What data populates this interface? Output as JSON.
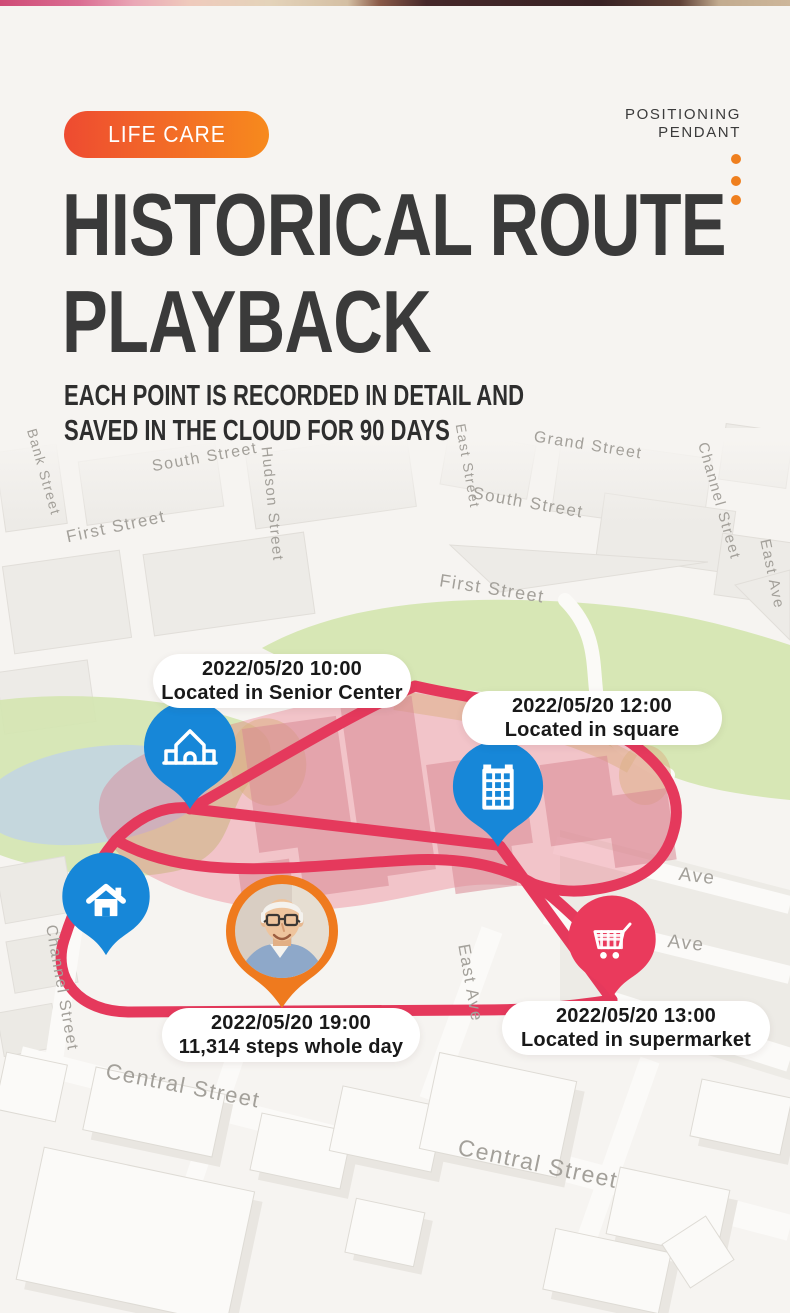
{
  "header": {
    "badge_label": "LIFE CARE",
    "product_line1": "POSITIONING",
    "product_line2": "PENDANT",
    "title_line1": "HISTORICAL ROUTE",
    "title_line2": "PLAYBACK",
    "subtitle_line1": "EACH POINT IS RECORDED IN DETAIL AND",
    "subtitle_line2": "SAVED IN THE CLOUD FOR 90 DAYS",
    "badge_gradient_start": "#ee4b31",
    "badge_gradient_end": "#f78a1d",
    "accent_dot_color": "#ef7f1e",
    "title_color": "#3a3a3a"
  },
  "map": {
    "route_color": "#e5395c",
    "zone_color": "#e9556e",
    "pin_blue": "#1787d8",
    "pin_red": "#ea3a5c",
    "pin_orange": "#ef7a1e",
    "park_color": "#d4e5b0",
    "lake_color": "#c2d4e4",
    "street_labels": [
      {
        "text": "South Street"
      },
      {
        "text": "Bank Street"
      },
      {
        "text": "Hudson Street"
      },
      {
        "text": "East Street"
      },
      {
        "text": "Grand Street"
      },
      {
        "text": "Channel Street"
      },
      {
        "text": "South Street"
      },
      {
        "text": "First Street"
      },
      {
        "text": "First Street"
      },
      {
        "text": "East Ave"
      },
      {
        "text": "Ave"
      },
      {
        "text": "Ave"
      },
      {
        "text": "East Ave"
      },
      {
        "text": "Channel Street"
      },
      {
        "text": "Central Street"
      },
      {
        "text": "Central Street"
      }
    ],
    "callouts": [
      {
        "id": "senior-center",
        "line1": "2022/05/20 10:00",
        "line2": "Located in Senior Center"
      },
      {
        "id": "square",
        "line1": "2022/05/20 12:00",
        "line2": "Located in square"
      },
      {
        "id": "steps",
        "line1": "2022/05/20 19:00",
        "line2": "11,314 steps whole day"
      },
      {
        "id": "supermarket",
        "line1": "2022/05/20 13:00",
        "line2": "Located in supermarket"
      }
    ],
    "pins": [
      {
        "id": "senior-center-pin",
        "icon": "building-outline-icon",
        "color": "#1787d8"
      },
      {
        "id": "square-pin",
        "icon": "office-building-icon",
        "color": "#1787d8"
      },
      {
        "id": "home-pin",
        "icon": "home-icon",
        "color": "#1787d8"
      },
      {
        "id": "supermarket-pin",
        "icon": "shopping-cart-icon",
        "color": "#ea3a5c"
      },
      {
        "id": "person-pin",
        "icon": "elderly-person-photo",
        "color": "#ef7a1e"
      }
    ]
  }
}
